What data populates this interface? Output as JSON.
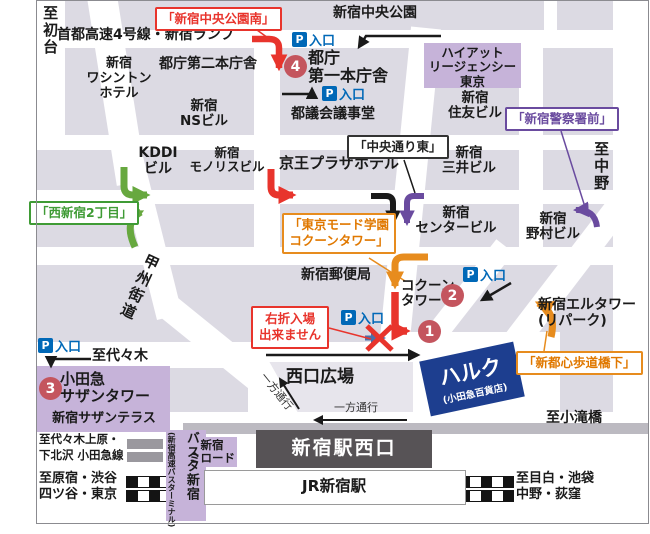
{
  "directions": {
    "hatsudai": "至初台",
    "nakano": "至中野",
    "yoyogi": "至代々木",
    "kotakibashi": "至小滝橋",
    "odakyu_line": "至代々木上原・\n下北沢 小田急線",
    "harajuku": "至原宿・渋谷",
    "yotsuya": "四ツ谷・東京",
    "mejiro": "至目白・池袋",
    "ogikubo": "中野・荻窪"
  },
  "roads": {
    "shuto": "首都高速4号線・新宿ランプ",
    "koshu": "甲州街道",
    "oneway_diag": "一方通行",
    "oneway_h": "一方通行"
  },
  "buildings": {
    "park": "新宿中央公園",
    "tocho2": "都庁第二本庁舎",
    "tocho1": "都庁\n第一本庁舎",
    "hyatt": "ハイアット\nリージェンシー\n東京",
    "washington": "新宿\nワシントン\nホテル",
    "ns": "新宿\nNSビル",
    "togikai": "都議会議事堂",
    "sumitomo": "新宿\n住友ビル",
    "kddi": "KDDI\nビル",
    "monolith": "新宿\nモノリスビル",
    "keio": "京王プラザホテル",
    "mitsui": "新宿\n三井ビル",
    "center": "新宿\nセンタービル",
    "nomura": "新宿\n野村ビル",
    "postoffice": "新宿郵便局",
    "cocoon": "コクーン\nタワー",
    "eltower": "新宿エルタワー\n(リパーク)",
    "hiroba": "西口広場",
    "halc": "ハルク",
    "halc_sub": "(小田急百貨店)",
    "southern": "小田急\nサザンタワー",
    "terrace": "新宿サザンテラス",
    "basuta": "バスタ新宿",
    "basuta_sub": "(新宿高速バスターミナル)",
    "milord": "新宿\nミロード",
    "west_exit": "新宿駅西口",
    "jr": "JR新宿駅"
  },
  "callouts": {
    "park_south": "「新宿中央公園南」",
    "nishi2": "「西新宿2丁目」",
    "chuo_east": "「中央通り東」",
    "mode": "「東京モード学園\nコクーンタワー」",
    "police": "「新宿警察署前」",
    "hodokyo": "「新都心歩道橋下」",
    "no_right_turn": "右折入場\n出来ません"
  },
  "parking": {
    "badge": "P",
    "text": "入口"
  },
  "markers": {
    "one": "1",
    "two": "2",
    "three": "3",
    "four": "4"
  },
  "colors": {
    "route_red": "#e8342c",
    "route_green": "#67a83f",
    "route_orange": "#e78c1e",
    "route_purple": "#6a4b9f",
    "route_black": "#1a1a1a",
    "parking_blue": "#0068b7",
    "marker_circle": "#c4555e",
    "block_gray": "#dcdae3",
    "highlight_purple": "#c6b3d9",
    "station_bar": "#575356",
    "halc_blue": "#1d3e8f"
  }
}
